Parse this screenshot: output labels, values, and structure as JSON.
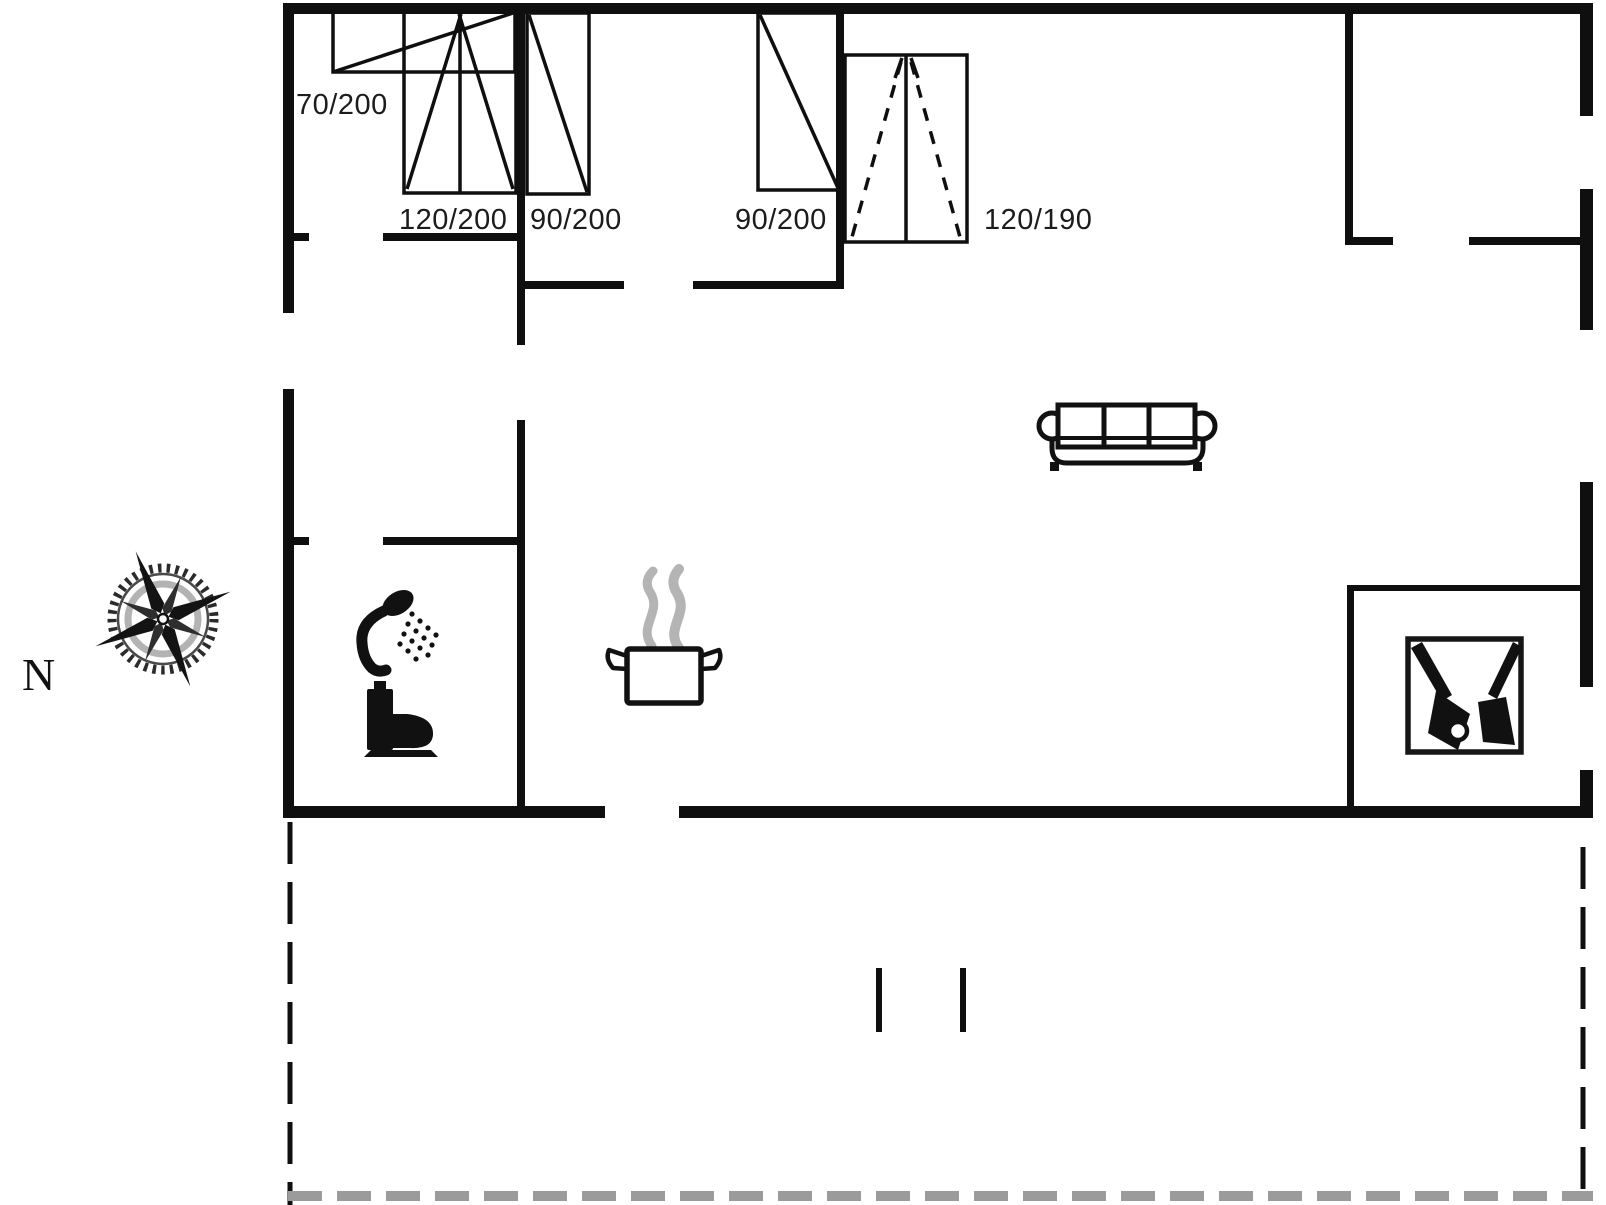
{
  "drawing": {
    "kind": "house floor plan",
    "north_label": "N",
    "openings": [
      {
        "id": "opening-70x200",
        "label": "70/200"
      },
      {
        "id": "window-120x200",
        "label": "120/200"
      },
      {
        "id": "door-90x200-left",
        "label": "90/200"
      },
      {
        "id": "door-90x200-right",
        "label": "90/200"
      },
      {
        "id": "double-door-120x190",
        "label": "120/190"
      }
    ],
    "icons": [
      "compass-rose-icon",
      "shower-icon",
      "toilet-icon",
      "cooking-pot-icon",
      "sofa-icon",
      "wood-stove-icon"
    ],
    "colors": {
      "line": "#0f0f0f",
      "steam": "#b4b4b4",
      "terrace_dash": "#9b9b9b",
      "background": "#ffffff"
    }
  }
}
